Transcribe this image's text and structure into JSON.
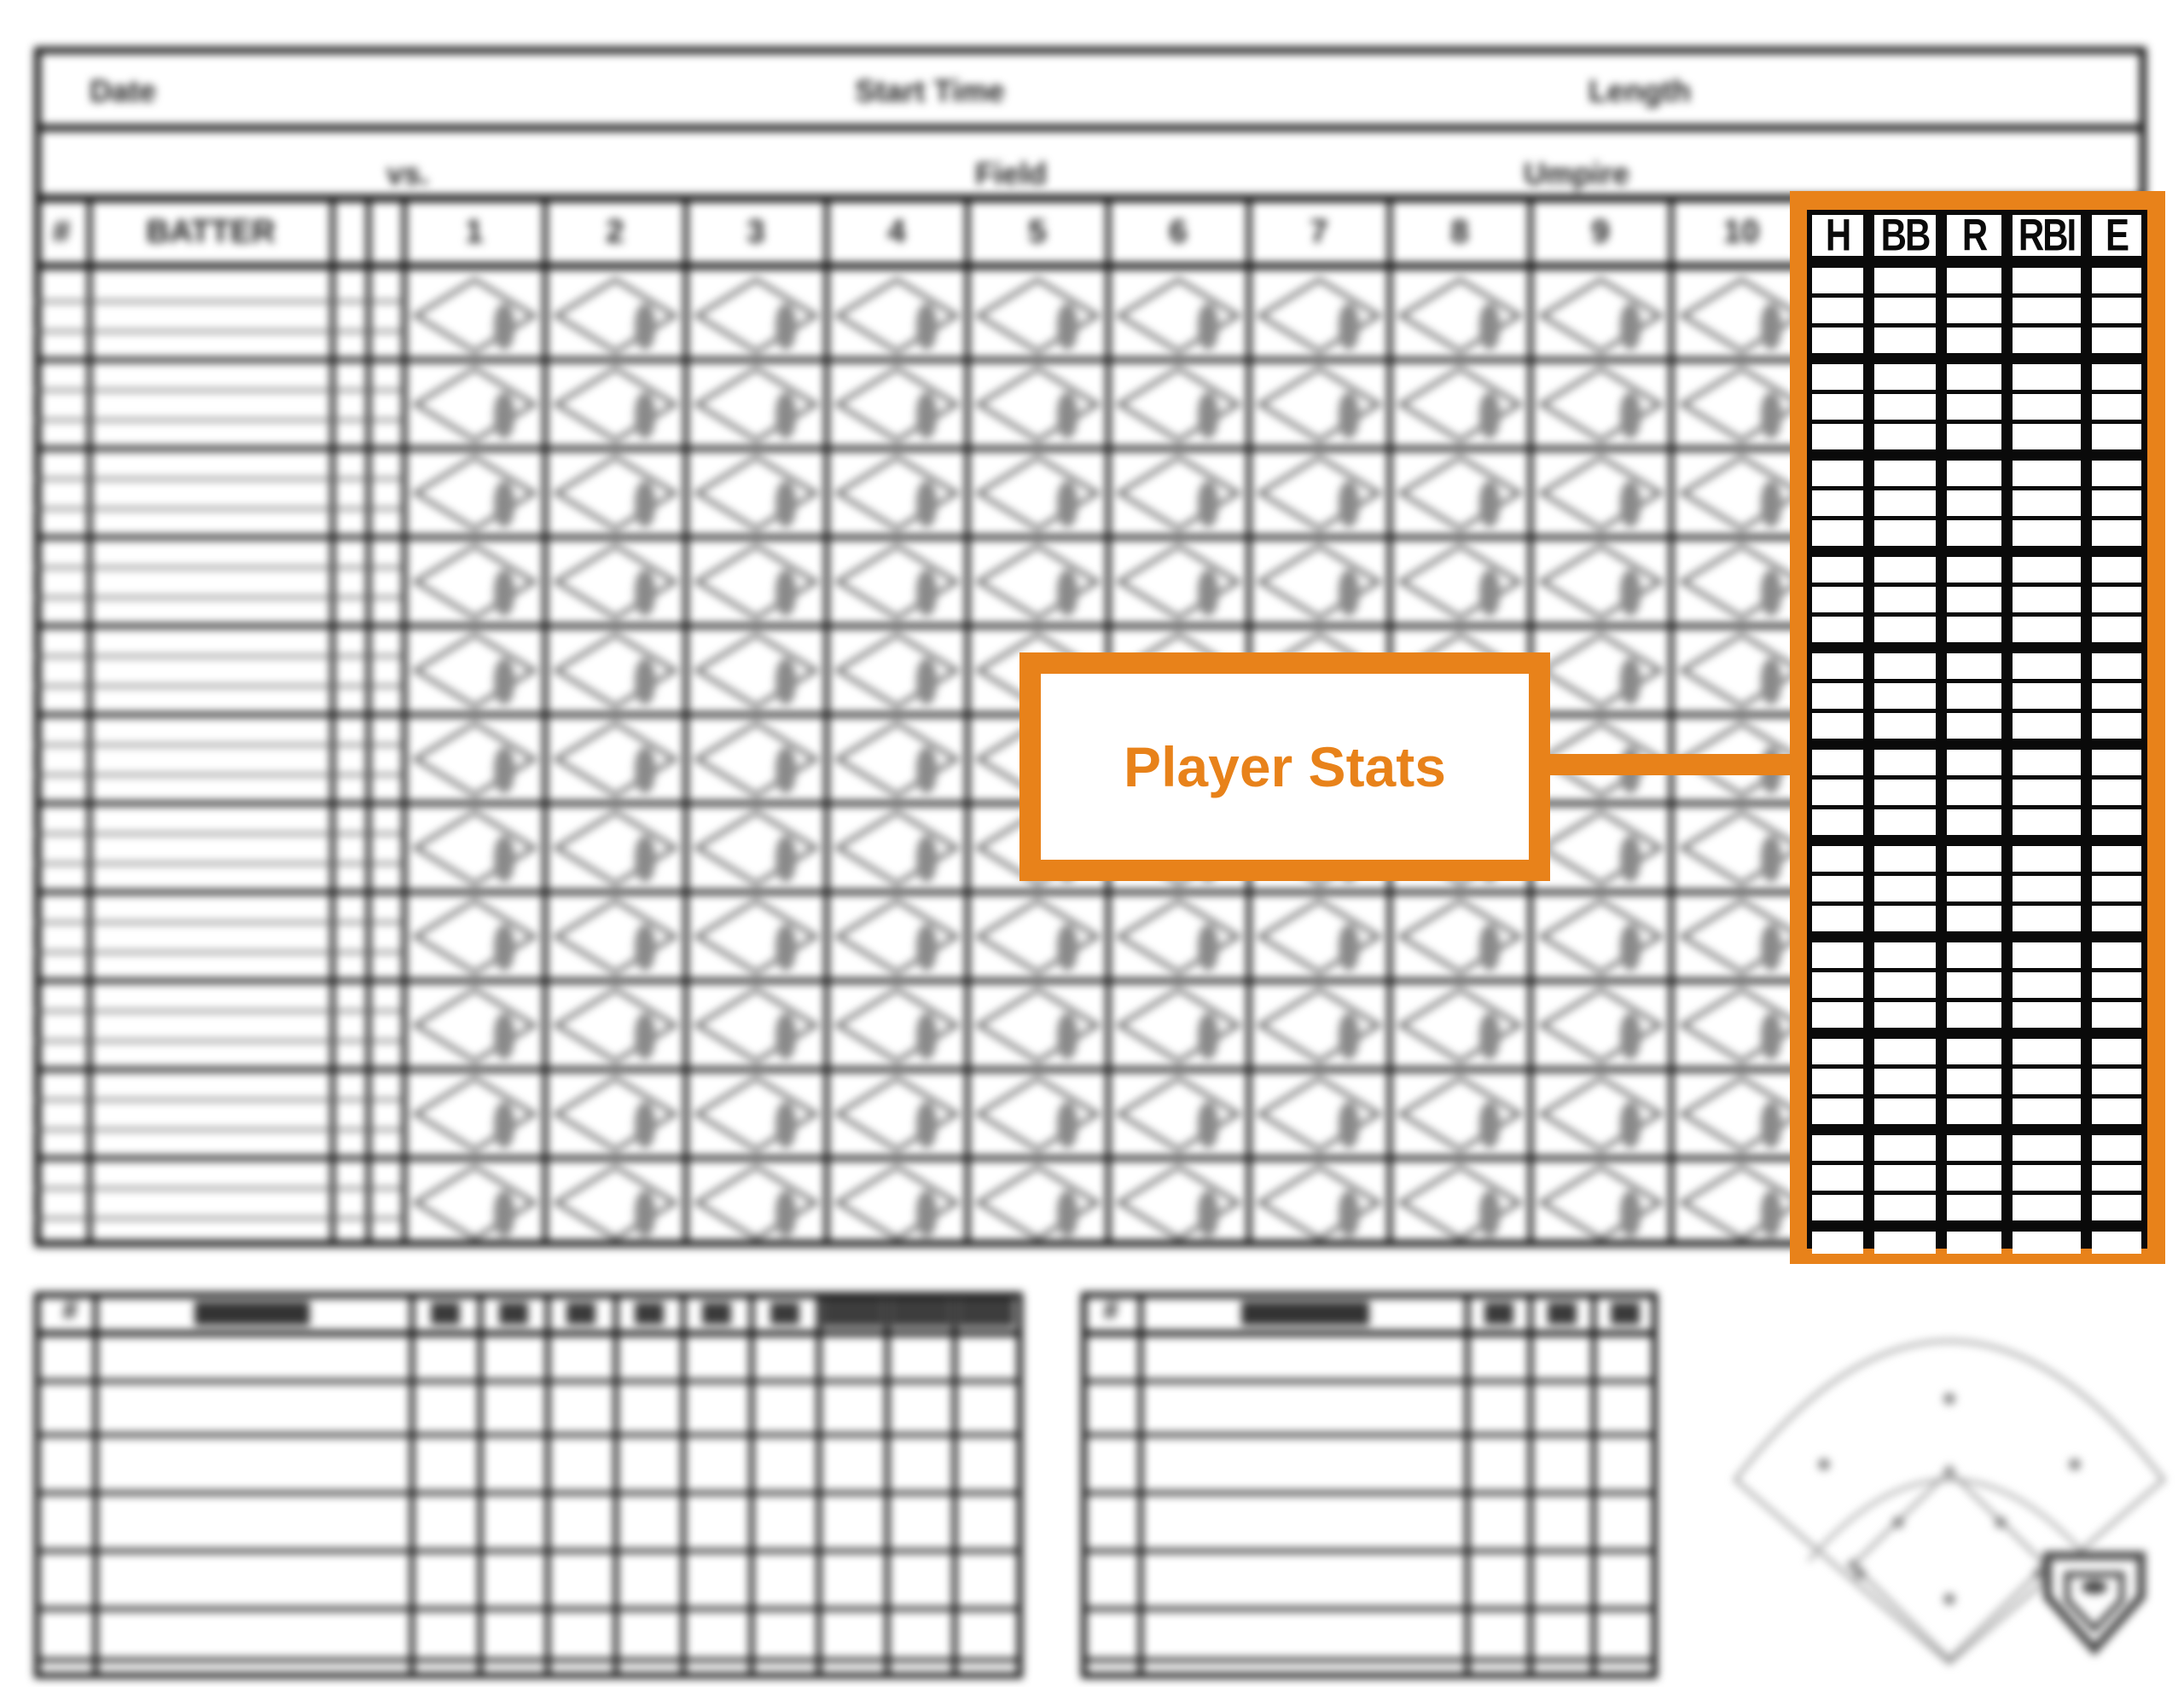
{
  "colors": {
    "accent": "#E8821A",
    "grid_black": "#101010"
  },
  "callout": {
    "label": "Player Stats"
  },
  "stats_panel": {
    "columns": [
      "H",
      "BB",
      "R",
      "RBI",
      "E"
    ],
    "batter_groups": 10,
    "rows_per_group": 3,
    "totals_row": true
  },
  "sheet": {
    "header_fields": [
      "Date",
      "Start Time",
      "Length"
    ],
    "info_fields": [
      "vs.",
      "Field",
      "Umpire"
    ],
    "grid": {
      "number_header": "#",
      "batter_header": "BATTER",
      "innings": [
        "1",
        "2",
        "3",
        "4",
        "5",
        "6",
        "7",
        "8",
        "9",
        "10"
      ],
      "batter_rows": 11,
      "sub_rows_per_batter": 3
    },
    "pitcher_table": {
      "number_header": "#",
      "stat_columns": 9,
      "shaded_columns": 3,
      "rows": 6
    },
    "bench_table": {
      "number_header": "#",
      "stat_columns": 3,
      "rows": 6
    },
    "icons": [
      "baseball-field-diagram",
      "home-plate-logo"
    ]
  }
}
